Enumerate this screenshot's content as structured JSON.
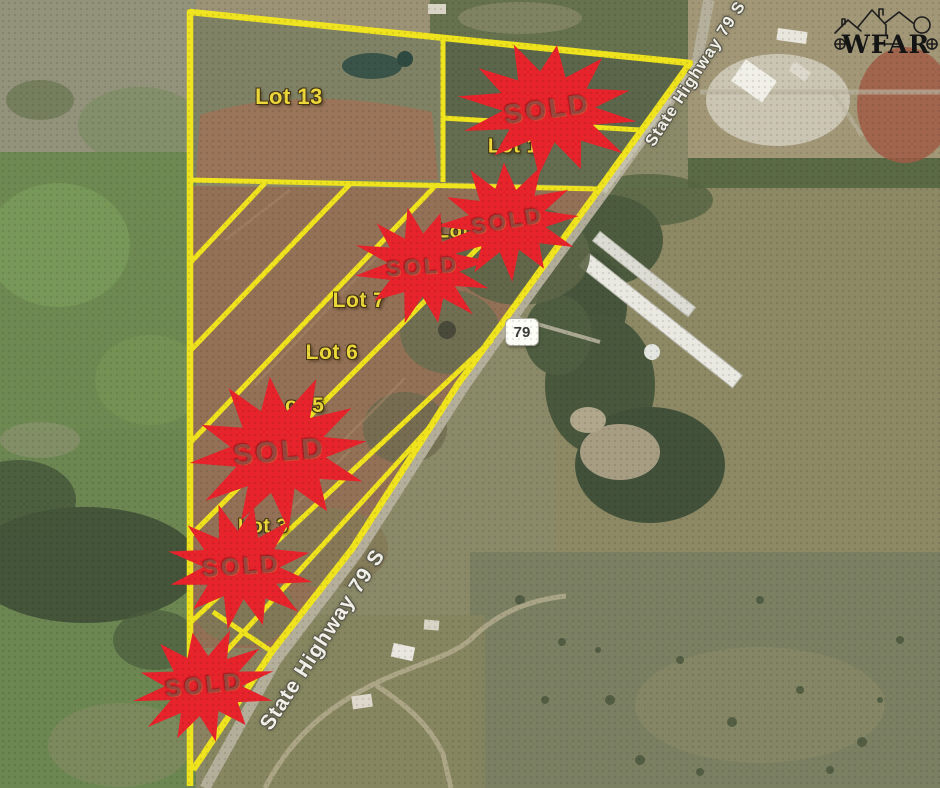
{
  "map": {
    "sold_badge": {
      "label": "SOLD",
      "count": 6,
      "fill_color": "#e7232b",
      "text_color": "#98493f"
    },
    "highway": {
      "name": "State Highway 79 S",
      "shield": "79"
    },
    "lots": [
      {
        "name": "Lot 13"
      },
      {
        "name": "Lot 1"
      },
      {
        "name": "Lot 8"
      },
      {
        "name": "Lot 7"
      },
      {
        "name": "Lot 6"
      },
      {
        "name": "Lot 5"
      },
      {
        "name": "Lot 3"
      }
    ],
    "colors": {
      "plat_line": "#f4e81c",
      "lot_label": "#ecd83a",
      "highway_text": "#f3f2ea"
    }
  },
  "logo": {
    "text": "WFAR"
  }
}
